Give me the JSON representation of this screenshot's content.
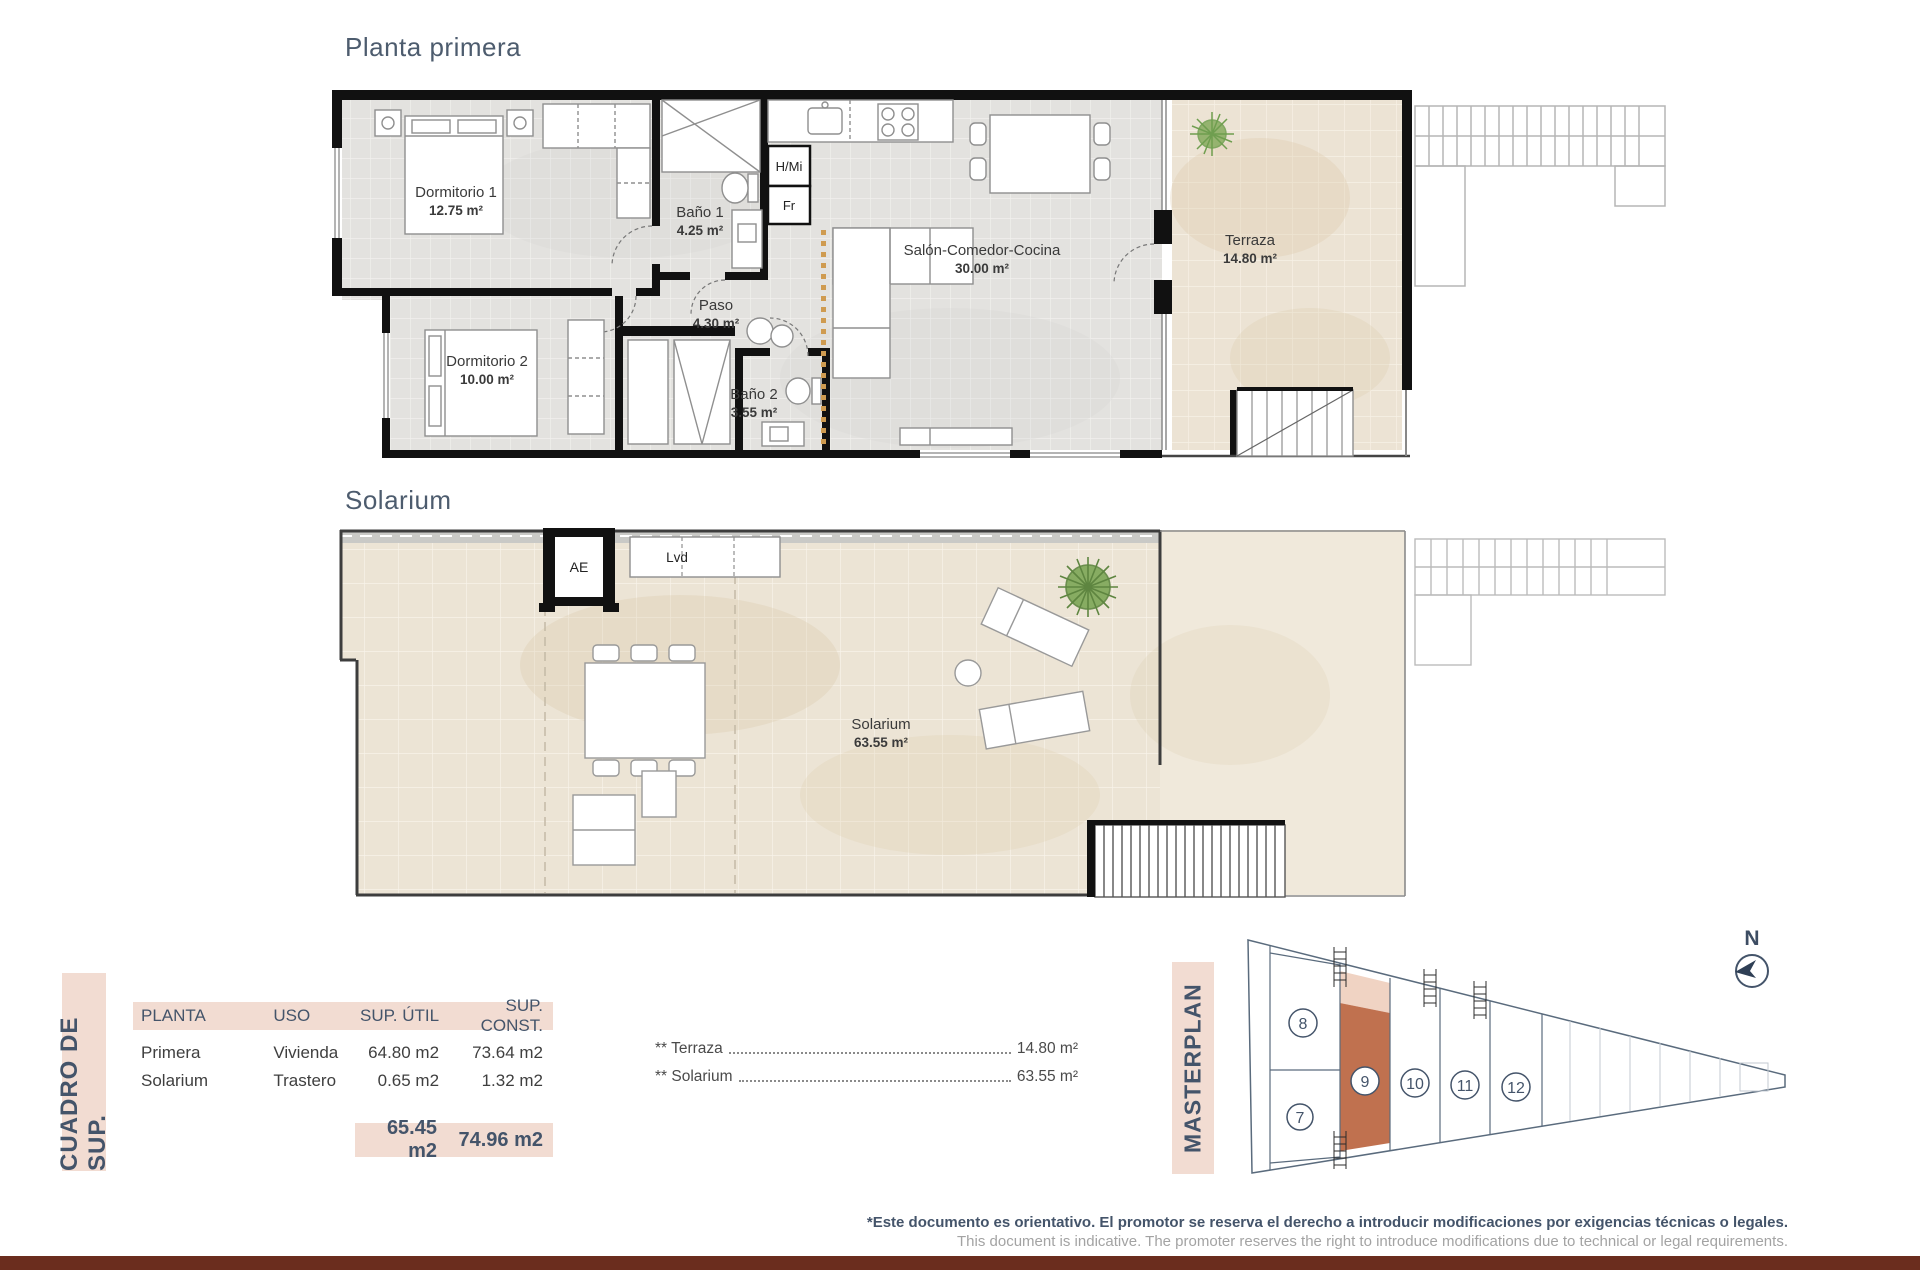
{
  "plan1": {
    "title": "Planta primera",
    "rooms": {
      "dormitorio1": {
        "name": "Dormitorio 1",
        "area": "12.75 m²"
      },
      "bano1": {
        "name": "Baño 1",
        "area": "4.25 m²"
      },
      "paso": {
        "name": "Paso",
        "area": "4.30 m²"
      },
      "dormitorio2": {
        "name": "Dormitorio 2",
        "area": "10.00 m²"
      },
      "bano2": {
        "name": "Baño 2",
        "area": "3.55 m²"
      },
      "salon": {
        "name": "Salón-Comedor-Cocina",
        "area": "30.00 m²"
      },
      "terraza": {
        "name": "Terraza",
        "area": "14.80 m²"
      }
    },
    "appliances": {
      "hmi": "H/Mi",
      "fr": "Fr"
    }
  },
  "plan2": {
    "title": "Solarium",
    "rooms": {
      "solarium": {
        "name": "Solarium",
        "area": "63.55 m²"
      }
    },
    "labels": {
      "ae": "AE",
      "lvd": "Lvd"
    }
  },
  "surface_table": {
    "side_label": "CUADRO DE SUP.",
    "headers": {
      "planta": "PLANTA",
      "uso": "USO",
      "util": "SUP. ÚTIL",
      "const": "SUP. CONST."
    },
    "rows": [
      {
        "planta": "Primera",
        "uso": "Vivienda",
        "util": "64.80 m2",
        "const": "73.64 m2"
      },
      {
        "planta": "Solarium",
        "uso": "Trastero",
        "util": "0.65 m2",
        "const": "1.32 m2"
      }
    ],
    "totals": {
      "util": "65.45 m2",
      "const": "74.96 m2"
    },
    "annotations": [
      {
        "label": "** Terraza",
        "value": "14.80 m²"
      },
      {
        "label": "** Solarium",
        "value": "63.55 m²"
      }
    ]
  },
  "masterplan": {
    "side_label": "MASTERPLAN",
    "north_label": "N",
    "units": {
      "u7": "7",
      "u8": "8",
      "u9": "9",
      "u10": "10",
      "u11": "11",
      "u12": "12"
    },
    "highlighted_unit": "9"
  },
  "footer": {
    "line1": "*Este documento es orientativo. El promotor se reserva el derecho a introducir modificaciones por exigencias técnicas o legales.",
    "line2": "This document is indicative. The promoter reserves the right to introduce modifications due to technical or legal requirements."
  },
  "colors": {
    "accent_navy": "#44546a",
    "table_pink": "#f2dcd2",
    "highlight_terracotta": "#c0714f",
    "highlight_light": "#f0d3c3",
    "footer_bar": "#6b2d1e"
  }
}
